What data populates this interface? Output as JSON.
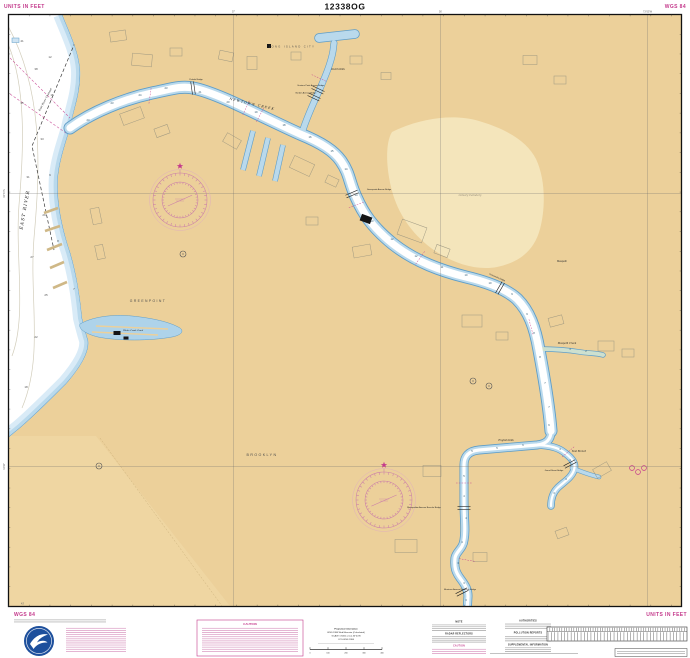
{
  "chart": {
    "number": "12338OG",
    "units_note_top_left": "UNITS IN FEET",
    "datum_top_right": "WGS 84",
    "datum_bottom_left": "WGS 84",
    "units_note_bottom_right": "UNITS IN FEET",
    "caution_title": "CAUTION",
    "corner_lat_label": "43'"
  },
  "logo": {
    "name": "NOAA"
  },
  "title_block": {
    "lines": [
      "Projection Information",
      "WGS 1984 Web Mercator (Calculated)",
      "SCALE 1:5000 at Lat 40°44'N",
      "CCS WGS 1984"
    ],
    "scale_ticks": [
      "0",
      "100",
      "200",
      "300",
      "400"
    ]
  },
  "notes": {
    "column_a_headers": [
      "NOTE",
      "RADAR REFLECTORS",
      "CAUTION"
    ],
    "column_b_headers": [
      "AUTHORITIES",
      "POLLUTION REPORTS",
      "SUPPLEMENTAL INFORMATION"
    ]
  },
  "graticule": {
    "verticals": [
      {
        "x": 233.5,
        "label": "57'"
      },
      {
        "x": 440.5,
        "label": "56'"
      },
      {
        "x": 647.5,
        "label": "73°55'W"
      }
    ],
    "horizontals": [
      {
        "y": 193.5,
        "label": "40°44'N"
      },
      {
        "y": 466.5,
        "label": "43'30\""
      }
    ]
  },
  "map": {
    "labels": [
      {
        "t": "EAST RIVER",
        "x": 26,
        "y": 210,
        "r": -80,
        "s": 4.5,
        "c": "water2"
      },
      {
        "t": "East River Channel",
        "x": 46,
        "y": 100,
        "r": -62,
        "s": 2.6,
        "c": "water"
      },
      {
        "t": "LONG ISLAND CITY",
        "x": 292,
        "y": 47.5,
        "r": 0,
        "s": 2.6,
        "c": "city"
      },
      {
        "t": "Hunters Point Avenue Bridge",
        "x": 311,
        "y": 86,
        "r": 0,
        "s": 2.1,
        "c": "bridge"
      },
      {
        "t": "Borden Avenue Bridge",
        "x": 306,
        "y": 93.5,
        "r": 0,
        "s": 2.1,
        "c": "bridge"
      },
      {
        "t": "Dutch Kills",
        "x": 338,
        "y": 70,
        "r": 0,
        "s": 2.4,
        "c": "water"
      },
      {
        "t": "Pulaski Bridge",
        "x": 196,
        "y": 80,
        "r": 0,
        "s": 2.1,
        "c": "bridge"
      },
      {
        "t": "NEWTOWN CREEK",
        "x": 252,
        "y": 105,
        "r": 13,
        "s": 3.2,
        "c": "water2"
      },
      {
        "t": "Greenpoint Avenue Bridge",
        "x": 379,
        "y": 190,
        "r": 0,
        "s": 2.1,
        "c": "bridge"
      },
      {
        "t": "GREENPOINT",
        "x": 148,
        "y": 302,
        "r": 0,
        "s": 3.4,
        "c": "city"
      },
      {
        "t": "Whale Creek Canal",
        "x": 133,
        "y": 331,
        "r": 0,
        "s": 2.1,
        "c": "water"
      },
      {
        "t": "Kosciuszko Bridge",
        "x": 497,
        "y": 278,
        "r": 24,
        "s": 2.1,
        "c": "bridge"
      },
      {
        "t": "Calvary Cemetery",
        "x": 470,
        "y": 196,
        "r": 0,
        "s": 2.5,
        "c": "area"
      },
      {
        "t": "Maspeth",
        "x": 562,
        "y": 262,
        "r": 0,
        "s": 2.6,
        "c": "place"
      },
      {
        "t": "BROOKLYN",
        "x": 262,
        "y": 456,
        "r": 0,
        "s": 3.6,
        "c": "city"
      },
      {
        "t": "Maspeth Creek",
        "x": 567,
        "y": 344,
        "r": 0,
        "s": 2.4,
        "c": "water"
      },
      {
        "t": "English Kills",
        "x": 506,
        "y": 441,
        "r": 0,
        "s": 2.4,
        "c": "water"
      },
      {
        "t": "East Branch",
        "x": 579,
        "y": 452,
        "r": 0,
        "s": 2.3,
        "c": "water"
      },
      {
        "t": "Grand Street Bridge",
        "x": 554,
        "y": 471,
        "r": 0,
        "s": 2.1,
        "c": "bridge"
      },
      {
        "t": "Metropolitan Avenue Bascule Bridge",
        "x": 424,
        "y": 508,
        "r": 0,
        "s": 2.1,
        "c": "bridge"
      },
      {
        "t": "Montrose Avenue Retractile Bridge",
        "x": 460,
        "y": 590,
        "r": 0,
        "s": 2.1,
        "c": "bridge"
      }
    ],
    "soundings_creek": [
      [
        23,
        88,
        121
      ],
      [
        23,
        112,
        104
      ],
      [
        24,
        140,
        96
      ],
      [
        23,
        166,
        89
      ],
      [
        21,
        200,
        93
      ],
      [
        20,
        228,
        103
      ],
      [
        19,
        256,
        113
      ],
      [
        18,
        284,
        126
      ],
      [
        16,
        310,
        138
      ],
      [
        15,
        332,
        152
      ],
      [
        14,
        346,
        170
      ],
      [
        14,
        356,
        196
      ],
      [
        13,
        372,
        222
      ],
      [
        12,
        392,
        240
      ],
      [
        12,
        416,
        257
      ],
      [
        11,
        442,
        268
      ],
      [
        10,
        466,
        276
      ],
      [
        10,
        490,
        284
      ],
      [
        9,
        512,
        295
      ],
      [
        9,
        527,
        315
      ],
      [
        8,
        534,
        334
      ],
      [
        8,
        540,
        358
      ],
      [
        7,
        545,
        384
      ],
      [
        7,
        549,
        408
      ],
      [
        6,
        549,
        426
      ],
      [
        6,
        523,
        446
      ],
      [
        5,
        497,
        449
      ],
      [
        5,
        472,
        452
      ],
      [
        5,
        464,
        477
      ],
      [
        4,
        464,
        497
      ],
      [
        4,
        466,
        519
      ],
      [
        4,
        462,
        543
      ],
      [
        3,
        458,
        564
      ],
      [
        3,
        464,
        584
      ],
      [
        3,
        466,
        601
      ],
      [
        4,
        560,
        450
      ],
      [
        4,
        570,
        461
      ],
      [
        3,
        566,
        480
      ],
      [
        3,
        554,
        494
      ],
      [
        3,
        570,
        350
      ],
      [
        2,
        586,
        352
      ]
    ],
    "soundings_river": [
      [
        41,
        22,
        42
      ],
      [
        38,
        36,
        70
      ],
      [
        35,
        22,
        104
      ],
      [
        33,
        42,
        140
      ],
      [
        31,
        28,
        178
      ],
      [
        29,
        44,
        216
      ],
      [
        27,
        32,
        258
      ],
      [
        25,
        46,
        296
      ],
      [
        22,
        36,
        338
      ],
      [
        18,
        26,
        388
      ],
      [
        15,
        52,
        96
      ],
      [
        12,
        50,
        58
      ],
      [
        9,
        50,
        176
      ],
      [
        8,
        58,
        242
      ],
      [
        7,
        74,
        290
      ]
    ],
    "roses": [
      {
        "x": 180,
        "y": 200,
        "r": 27
      },
      {
        "x": 384,
        "y": 500,
        "r": 28
      }
    ]
  },
  "colors": {
    "magenta": "#c43a8c",
    "land": "#ecd09a",
    "land_light": "#f4e5bb",
    "shallow": "#b9d9ec",
    "shallow_light": "#d9ebf7",
    "channel_edge": "#5e9dc8",
    "deep_water": "#ffffff",
    "noaa_blue": "#1d4f9c"
  }
}
